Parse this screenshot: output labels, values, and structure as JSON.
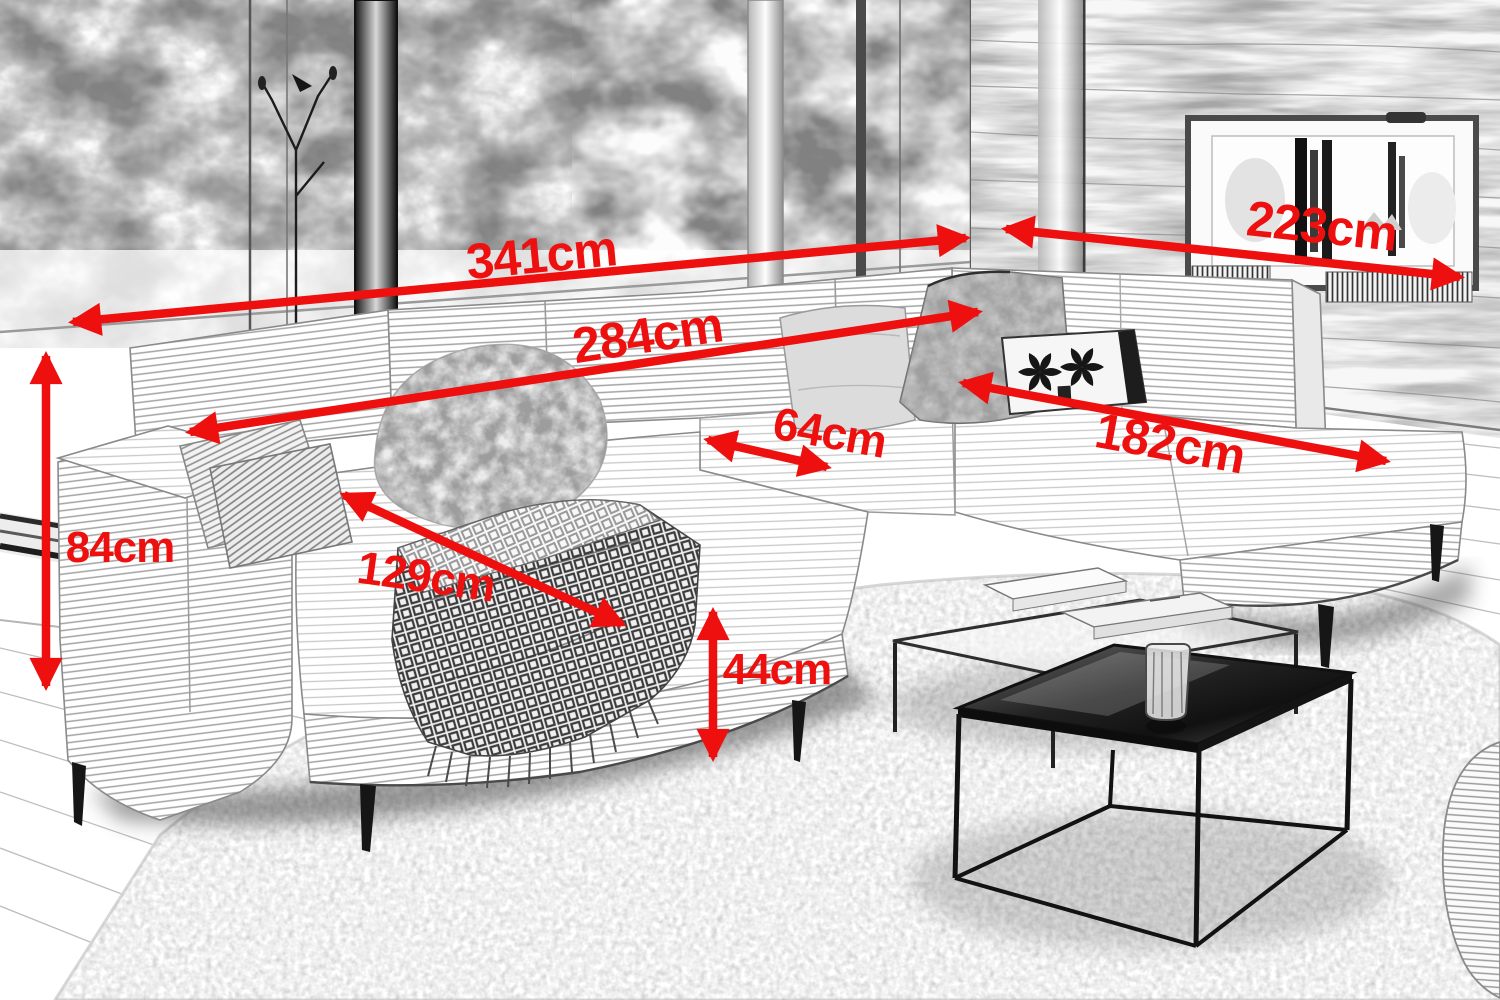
{
  "accent_color": "#ee0f0f",
  "unit": "cm",
  "dimensions": {
    "total_width": "341cm",
    "right_side_depth": "223cm",
    "inner_seat_width": "284cm",
    "seat_depth": "64cm",
    "right_chaise_length": "182cm",
    "backrest_height": "84cm",
    "left_chaise_width": "129cm",
    "seat_height": "44cm"
  },
  "icons": {
    "dimension_arrow": "red double-headed measurement arrow"
  }
}
